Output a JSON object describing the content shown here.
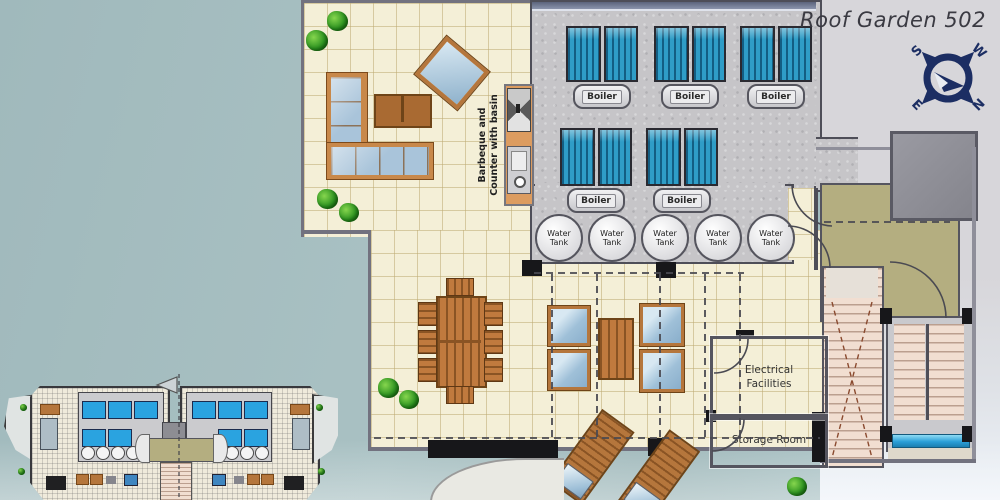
{
  "title": "Roof Garden 502",
  "compass": {
    "s": "S",
    "w": "W",
    "e": "E",
    "n": "N"
  },
  "plan": {
    "boilers": [
      "Boiler",
      "Boiler",
      "Boiler",
      "Boiler",
      "Boiler"
    ],
    "water_tanks": [
      "Water Tank",
      "Water Tank",
      "Water Tank",
      "Water Tank",
      "Water Tank"
    ],
    "barbeque_counter": "Barbeque and\nCounter with basin",
    "rooms": {
      "electrical": "Electrical Facilities",
      "storage": "Storage Room"
    }
  },
  "colors": {
    "background_left": "#a6bec0",
    "background_right": "#d7d6da",
    "terrace": "#f4efd7",
    "concrete": "#c6c5c8",
    "solar_panel": "#2f9dc7",
    "wood": "#c07a3e",
    "cushion": "#a9c4da",
    "landing_olive": "#b4ae80",
    "stairs_pink": "#f1ded1",
    "compass_navy": "#1c2e63",
    "pool_strip": "#2ba0d8"
  }
}
